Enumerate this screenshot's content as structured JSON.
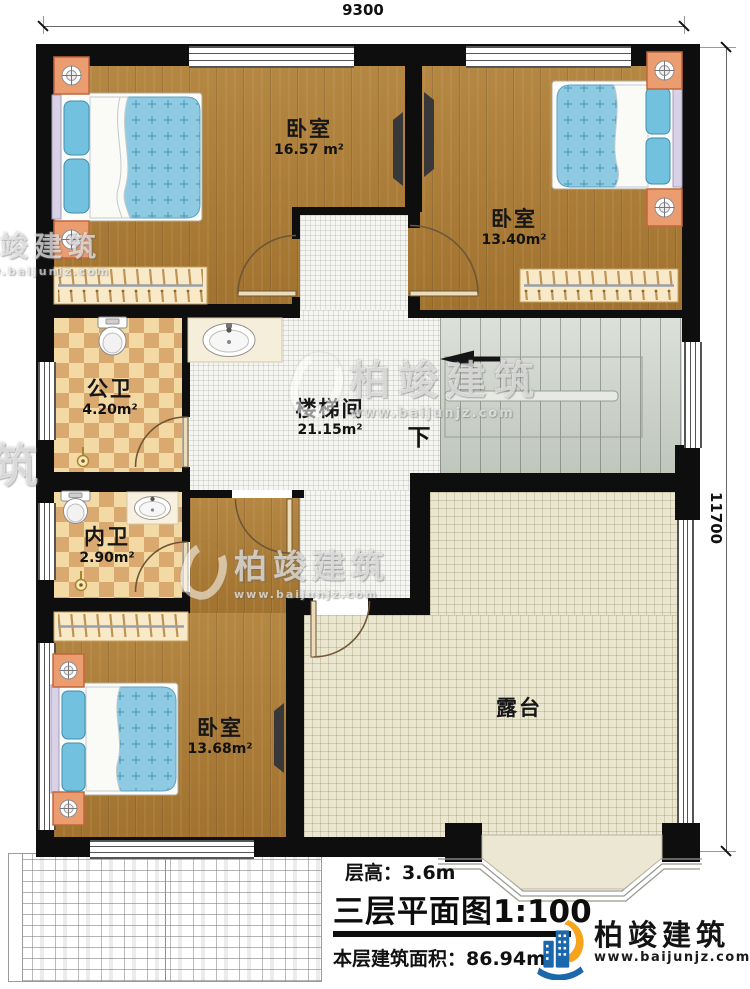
{
  "plan": {
    "dim_width": "9300",
    "dim_height": "11700"
  },
  "rooms": [
    {
      "name": "卧室",
      "area": "16.57 m²"
    },
    {
      "name": "卧室",
      "area": "13.40m²"
    },
    {
      "name": "公卫",
      "area": "4.20m²"
    },
    {
      "name": "楼梯间",
      "area": "21.15m²"
    },
    {
      "name": "内卫",
      "area": "2.90m²"
    },
    {
      "name": "卧室",
      "area": "13.68m²"
    },
    {
      "name": "露台",
      "area": ""
    }
  ],
  "stairs": {
    "down_label": "下"
  },
  "footer": {
    "floor_height": "层高：3.6m",
    "title": "三层平面图",
    "scale": "1:100",
    "area_text": "本层建筑面积：86.94m²"
  },
  "brand": {
    "name": "柏竣建筑",
    "site": "www.baijunjz.com"
  },
  "watermarks": [
    {
      "text": "柏竣建筑",
      "site": "www.baijunjz.com"
    },
    {
      "text": "柏竣建筑",
      "site": "www.baijunjz.com"
    },
    {
      "text": "柏竣建筑",
      "site": "www.baijunjz.com"
    },
    {
      "text": "建筑",
      "site": ""
    }
  ],
  "colors": {
    "wall": "#111111",
    "wood": "#ab7b35",
    "tile_light": "#f3d9a4",
    "tile_dark": "#d9aa70",
    "hall_tile": "#f4f4f1",
    "stair": "#ced4cb",
    "terrace": "#ece7d2",
    "mattress": "#85c8e0",
    "brand_blue": "#1a67ab",
    "brand_orange": "#f7a41d"
  }
}
